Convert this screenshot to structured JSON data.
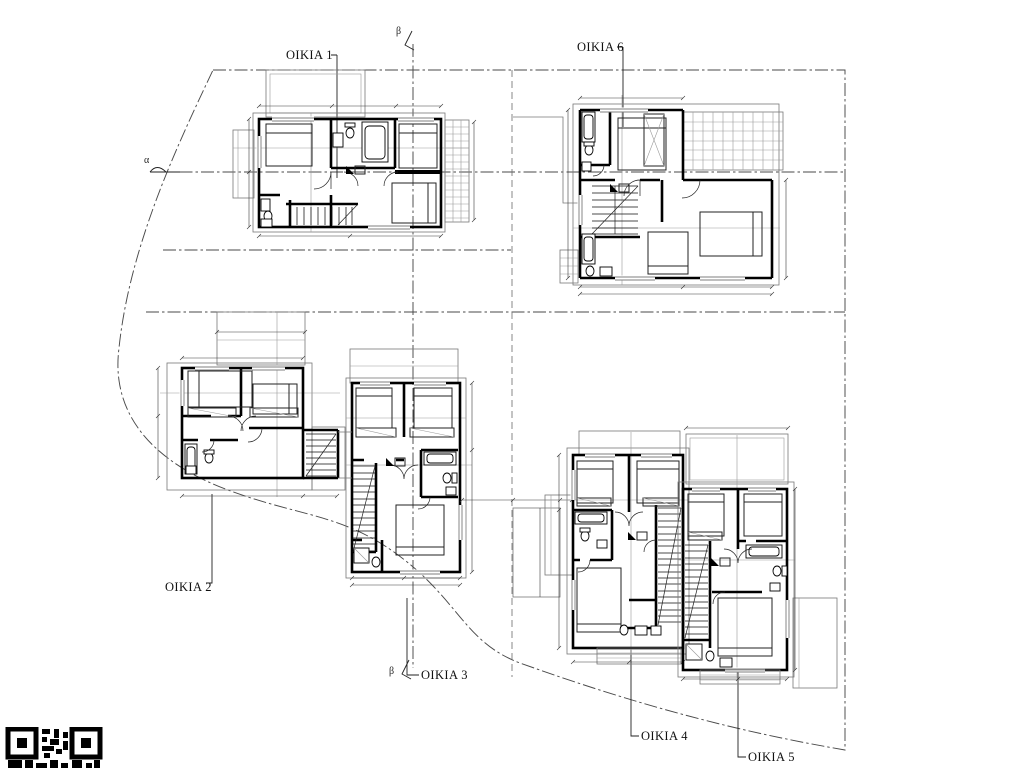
{
  "drawing": {
    "type": "architectural-site-floor-plan",
    "houses": [
      {
        "id": "oikia-1",
        "label": "OIKIA 1"
      },
      {
        "id": "oikia-2",
        "label": "OIKIA 2"
      },
      {
        "id": "oikia-3",
        "label": "OIKIA 3"
      },
      {
        "id": "oikia-4",
        "label": "OIKIA 4"
      },
      {
        "id": "oikia-5",
        "label": "OIKIA 5"
      },
      {
        "id": "oikia-6",
        "label": "OIKIA 6"
      }
    ],
    "section_markers": {
      "alpha": "α",
      "beta_top": "β",
      "beta_bottom": "β"
    },
    "colors": {
      "walls": "#000000",
      "boundary": "#4a4a4a",
      "secondary_outline": "#787878",
      "dimension_lines": "#3a3a3a",
      "background": "#ffffff"
    }
  }
}
